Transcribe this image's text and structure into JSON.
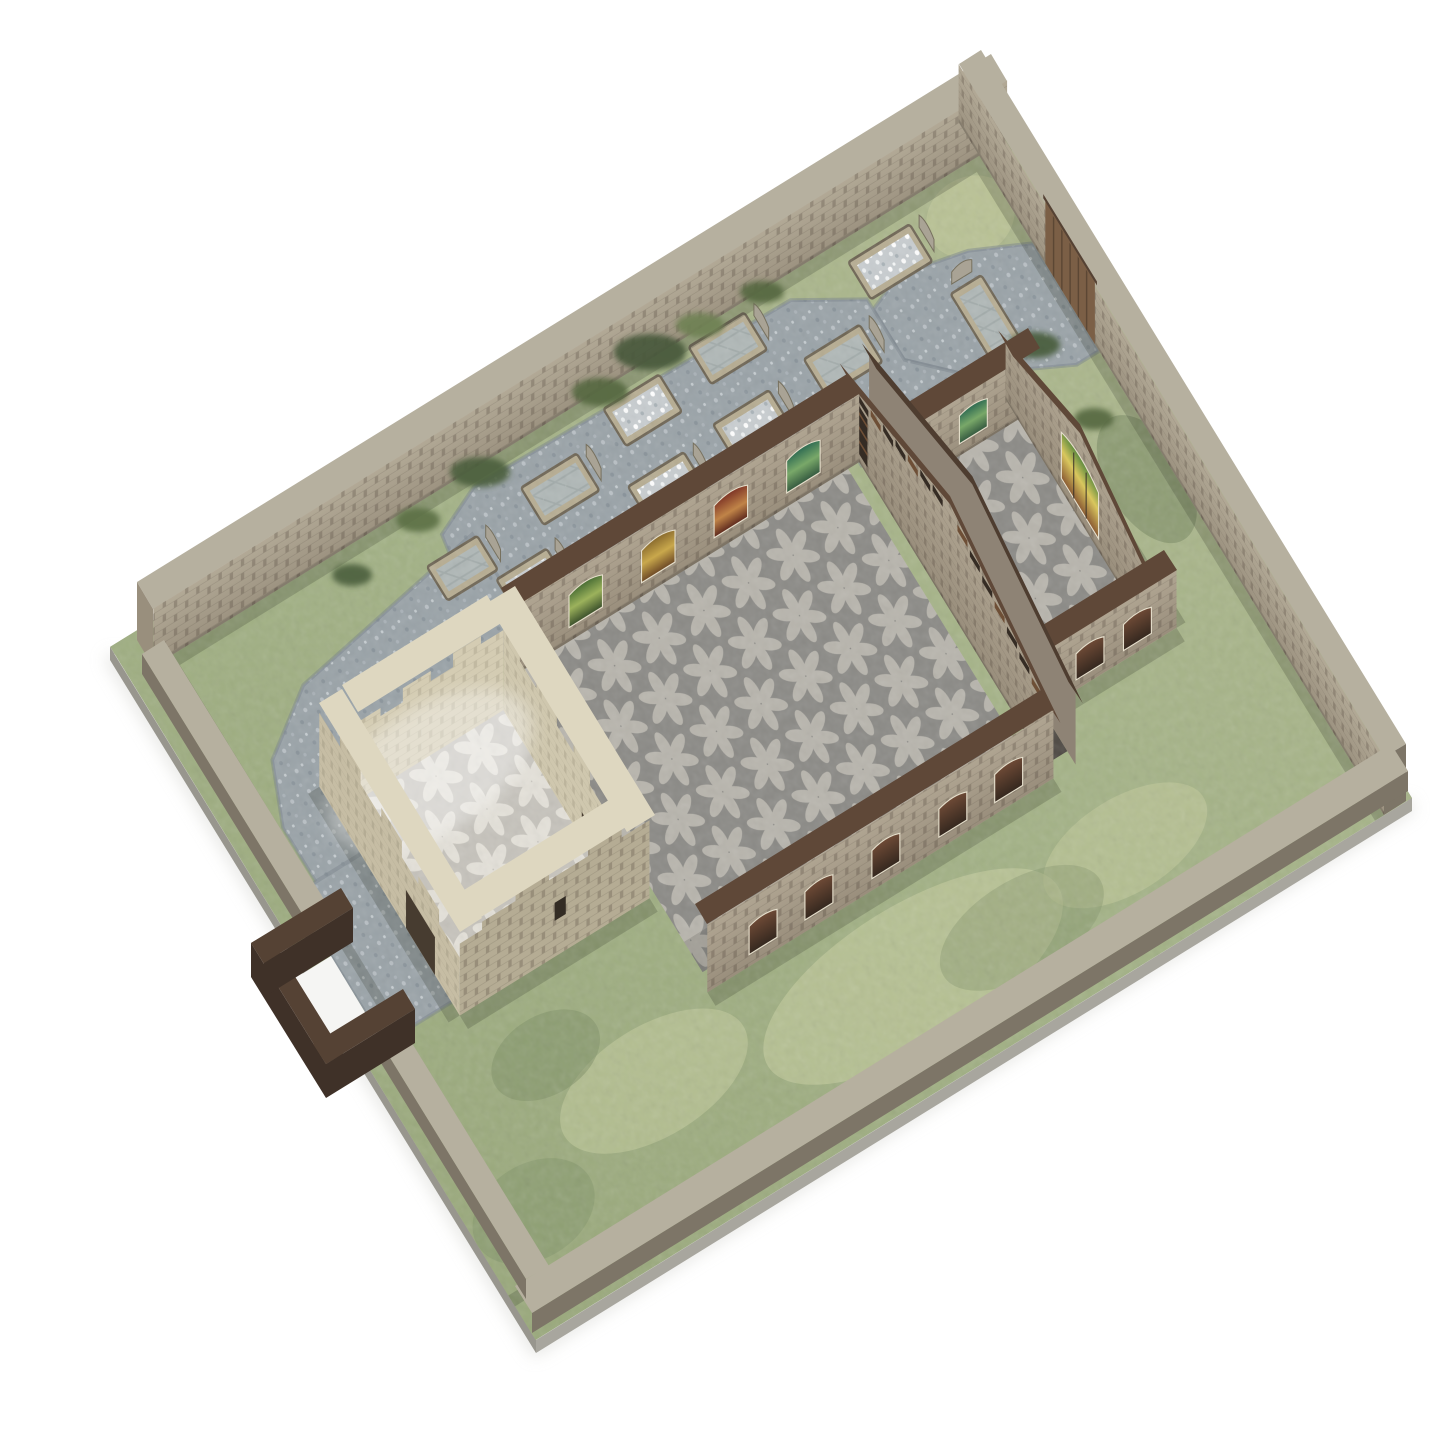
{
  "scene": {
    "type": "product-photo",
    "subject": "miniature ruined medieval church tabletop terrain model",
    "view": "high three-quarter top-down",
    "background": "#ffffff",
    "parts": [
      "walled churchyard base",
      "roofless nave",
      "chancel with east window",
      "ruined bell tower",
      "graveyard with tombs and headstones",
      "lych gate",
      "wooden yard gate",
      "gravel paths",
      "grass groundwork"
    ]
  },
  "colors": {
    "background": "#ffffff",
    "board_sliver": "#c0beb5",
    "board_sliver2": "#b2b0a7",
    "board_edge": "#a8a69e",
    "board_edge_dark": "#98968e",
    "grass_patch": "#ccd2a3",
    "moss": "#7e9066",
    "moss_dark": "#6c7f58",
    "gravel": "#9aa3a8",
    "gravel_edge": "#79838b",
    "tomb_curb": "#b7ad92",
    "tomb_curb_line": "#6e6554",
    "headstone": "#a9a395",
    "headstone_line": "#77715f",
    "wall_cap": "#b6b09f",
    "wall_end": "#998f7d",
    "wall_dark": "#7d7567",
    "church_cap": "#5f4838",
    "arch_hint": "#8e8375",
    "arch_hint_cap": "#4e3d30",
    "tower_cap": "#ded7c0",
    "tower_face_light": "#d4ccb3",
    "tower_face_mid": "#c6bda4",
    "tower_face_inner": "#cfc7ae",
    "tower_face_shadow": "#b5ac94",
    "wood_gate": "#7b5f46",
    "wood_dark": "#3f3128",
    "wood_mid": "#554234",
    "white_gap": "#f5f5f3",
    "floor_bg": "#8b8a86",
    "floor_petal": "#b8b5ad",
    "floor_light_bg": "#c6c3bc",
    "floor_light_petal": "#e4e1d9",
    "window_frame": "#e6dfcc",
    "socket": "#352c24",
    "socket_wood": "#6e4f36",
    "slit": "#332c24",
    "door_dark": "#473c30",
    "pebbles_bg": "#c8cdd0",
    "slab": "#b0b8b7"
  },
  "graveyard": {
    "tombs": [
      {
        "px": 24,
        "py": 9.5,
        "w": 11,
        "h": 5.5,
        "fill": "pebbles",
        "hs": true
      },
      {
        "px": 38,
        "py": 17,
        "w": 10,
        "h": 5.5,
        "fill": "slab",
        "hs": true
      },
      {
        "px": 52,
        "py": 8,
        "w": 10,
        "h": 5.5,
        "fill": "slab",
        "hs": true
      },
      {
        "px": 55,
        "py": 18,
        "w": 10,
        "h": 5.5,
        "fill": "pebbles",
        "hs": true
      },
      {
        "px": 68,
        "py": 9,
        "w": 10,
        "h": 5.5,
        "fill": "pebbles",
        "hs": false
      },
      {
        "px": 71,
        "py": 19,
        "w": 10,
        "h": 5.5,
        "fill": "pebbles",
        "hs": true
      },
      {
        "px": 85,
        "py": 12,
        "w": 10,
        "h": 5.5,
        "fill": "slab",
        "hs": true
      },
      {
        "px": 96,
        "py": 20,
        "w": 9,
        "h": 5,
        "fill": "pebbles",
        "hs": true
      },
      {
        "px": 16,
        "py": 22,
        "w": 5.5,
        "h": 10,
        "fill": "slab",
        "hs": true,
        "rot": true
      },
      {
        "px": 104,
        "py": 14,
        "w": 9,
        "h": 5,
        "fill": "slab",
        "hs": true
      }
    ],
    "bushes": [
      {
        "x": 650,
        "y": 352,
        "rx": 36,
        "ry": 18,
        "c": "#46583a"
      },
      {
        "x": 600,
        "y": 392,
        "rx": 28,
        "ry": 14,
        "c": "#55683f"
      },
      {
        "x": 700,
        "y": 325,
        "rx": 24,
        "ry": 12,
        "c": "#6e8152"
      },
      {
        "x": 762,
        "y": 292,
        "rx": 22,
        "ry": 11,
        "c": "#55683f"
      },
      {
        "x": 480,
        "y": 472,
        "rx": 30,
        "ry": 15,
        "c": "#4b5e3c"
      },
      {
        "x": 418,
        "y": 520,
        "rx": 22,
        "ry": 12,
        "c": "#5b6f45"
      },
      {
        "x": 352,
        "y": 575,
        "rx": 20,
        "ry": 11,
        "c": "#4b5e3c"
      },
      {
        "x": 1034,
        "y": 345,
        "rx": 26,
        "ry": 13,
        "c": "#475c3b"
      },
      {
        "x": 1094,
        "y": 419,
        "rx": 20,
        "ry": 11,
        "c": "#55683f"
      }
    ]
  },
  "church": {
    "window_groups": [
      {
        "id": "f-nave-n",
        "xs": [
          10,
          23,
          36,
          49
        ],
        "w": 6,
        "sill": -14,
        "top": -46,
        "arch": 8,
        "glasses": [
          "gTeal",
          "gRed",
          "gAmber",
          "gGreen"
        ]
      },
      {
        "id": "f-nave-s",
        "xs": [
          8,
          18,
          30,
          42,
          52
        ],
        "w": 5,
        "sill": -12,
        "top": -40,
        "arch": 6,
        "glasses": [
          "gDark"
        ]
      },
      {
        "id": "f-chan-n",
        "xs": [
          9
        ],
        "w": 5,
        "sill": -12,
        "top": -40,
        "arch": 6,
        "glasses": [
          "gTeal"
        ]
      },
      {
        "id": "f-chan-e",
        "xs": [
          18
        ],
        "w": 9,
        "sill": -12,
        "top": -58,
        "arch": 12,
        "glasses": [
          "gBright"
        ],
        "mullions": true
      },
      {
        "id": "f-chan-s",
        "xs": [
          7,
          15.5
        ],
        "w": 5,
        "sill": -10,
        "top": -36,
        "arch": 6,
        "glasses": [
          "gDark"
        ]
      }
    ],
    "arch_sockets": [
      4,
      7,
      10,
      13,
      16,
      19,
      22,
      28,
      31,
      34,
      37,
      40,
      43,
      46
    ]
  }
}
